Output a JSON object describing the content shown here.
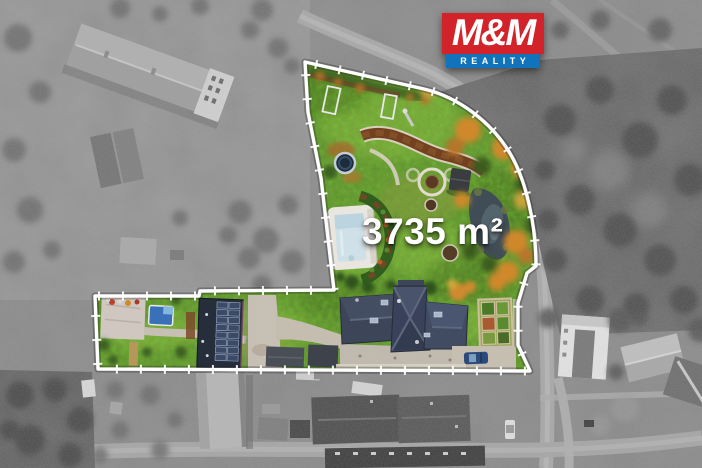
{
  "overlay": {
    "logo": {
      "title": "M&M",
      "subtitle": "REALITY",
      "title_bg_color": "#d2232a",
      "subtitle_bg_color": "#1173b9",
      "text_color": "#ffffff"
    },
    "area_label": {
      "text": "3735 m²",
      "color": "#ffffff"
    }
  },
  "scene": {
    "kind": "drone-aerial-photo",
    "surroundings_style": "grayscale",
    "highlight": {
      "boundary_color": "#ffffff",
      "grass_color": "#5f9130",
      "features": [
        "lawn",
        "swimming-pool",
        "pond",
        "house-roof",
        "solar-roof-building",
        "driveway",
        "garden-beds",
        "autumn-trees",
        "playground",
        "hot-tub",
        "stone-circle",
        "car"
      ]
    }
  }
}
